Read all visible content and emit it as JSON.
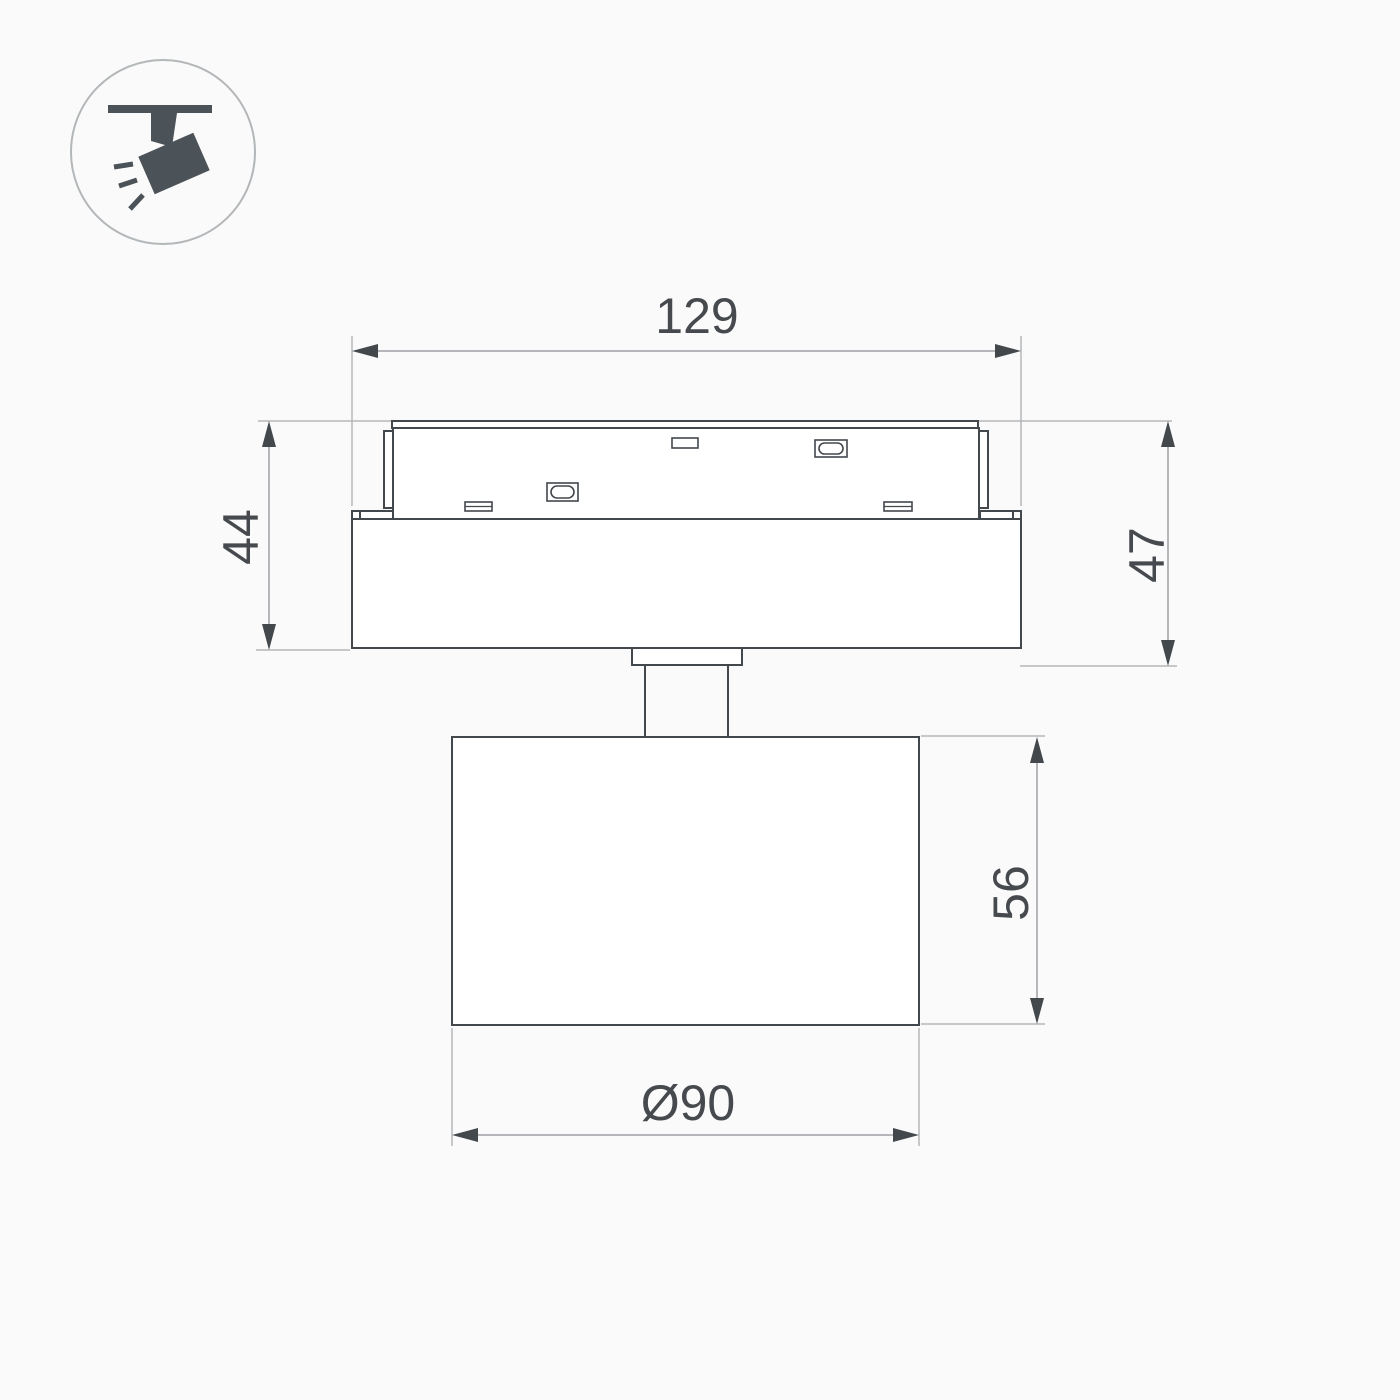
{
  "drawing": {
    "kind": "technical-dimension-drawing",
    "views": {
      "icon_label": "track-mounted-spotlight"
    },
    "dimensions": {
      "top_width": "129",
      "left_height": "44",
      "right_height": "47",
      "head_height": "56",
      "head_diameter": "Ø90"
    }
  },
  "icons": [
    {
      "name": "track-spotlight-icon",
      "meaning": "spotlight hanging from ceiling track, tilted, emitting light"
    }
  ],
  "colors": {
    "background": "#fafafa",
    "object_line": "#43484d",
    "dimension_line": "#9da0a3",
    "extension_line": "#b4b7b9",
    "text": "#46494d",
    "icon_fill": "#4b5258"
  }
}
